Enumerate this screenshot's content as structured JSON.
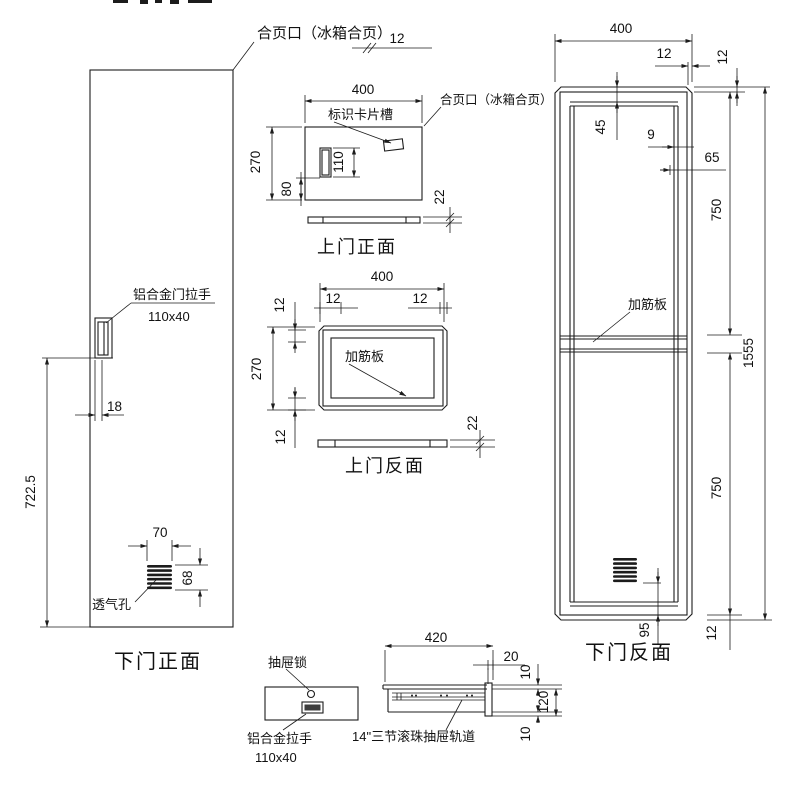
{
  "colors": {
    "ink": "#1c1c1c",
    "background": "#ffffff"
  },
  "labels": {
    "hinge_note_top": "合页口（冰箱合页）",
    "hinge_note_upper": "合页口（冰箱合页）",
    "card_slot": "标识卡片槽",
    "door_handle": "铝合金门拉手",
    "door_handle_size": "110x40",
    "vent_hole": "透气孔",
    "rib_upper_back": "加筋板",
    "rib_lower_back": "加筋板",
    "drawer_lock": "抽屉锁",
    "drawer_handle": "铝合金拉手",
    "drawer_handle_size": "110x40",
    "drawer_rail": "14\"三节滚珠抽屉轨道"
  },
  "titles": {
    "lower_front": "下门正面",
    "upper_front": "上门正面",
    "upper_back": "上门反面",
    "lower_back": "下门反面"
  },
  "dims": {
    "hinge12": "12",
    "uf": {
      "w400": "400",
      "h270": "270",
      "h110": "110",
      "b80": "80",
      "t22": "22"
    },
    "ub": {
      "w400": "400",
      "l12": "12",
      "r12": "12",
      "tl12": "12",
      "bl12": "12",
      "h270": "270",
      "t22": "22"
    },
    "lf": {
      "h7225": "722.5",
      "o18": "18",
      "v70": "70",
      "v68": "68"
    },
    "lb": {
      "w400": "400",
      "t12": "12",
      "tr12": "12",
      "d45": "45",
      "d9": "9",
      "d65": "65",
      "p750u": "750",
      "h1555": "1555",
      "p750l": "750",
      "d95": "95",
      "br12": "12"
    },
    "dr": {
      "w420": "420",
      "d20": "20",
      "t10": "10",
      "h120": "120",
      "b10": "10"
    }
  }
}
